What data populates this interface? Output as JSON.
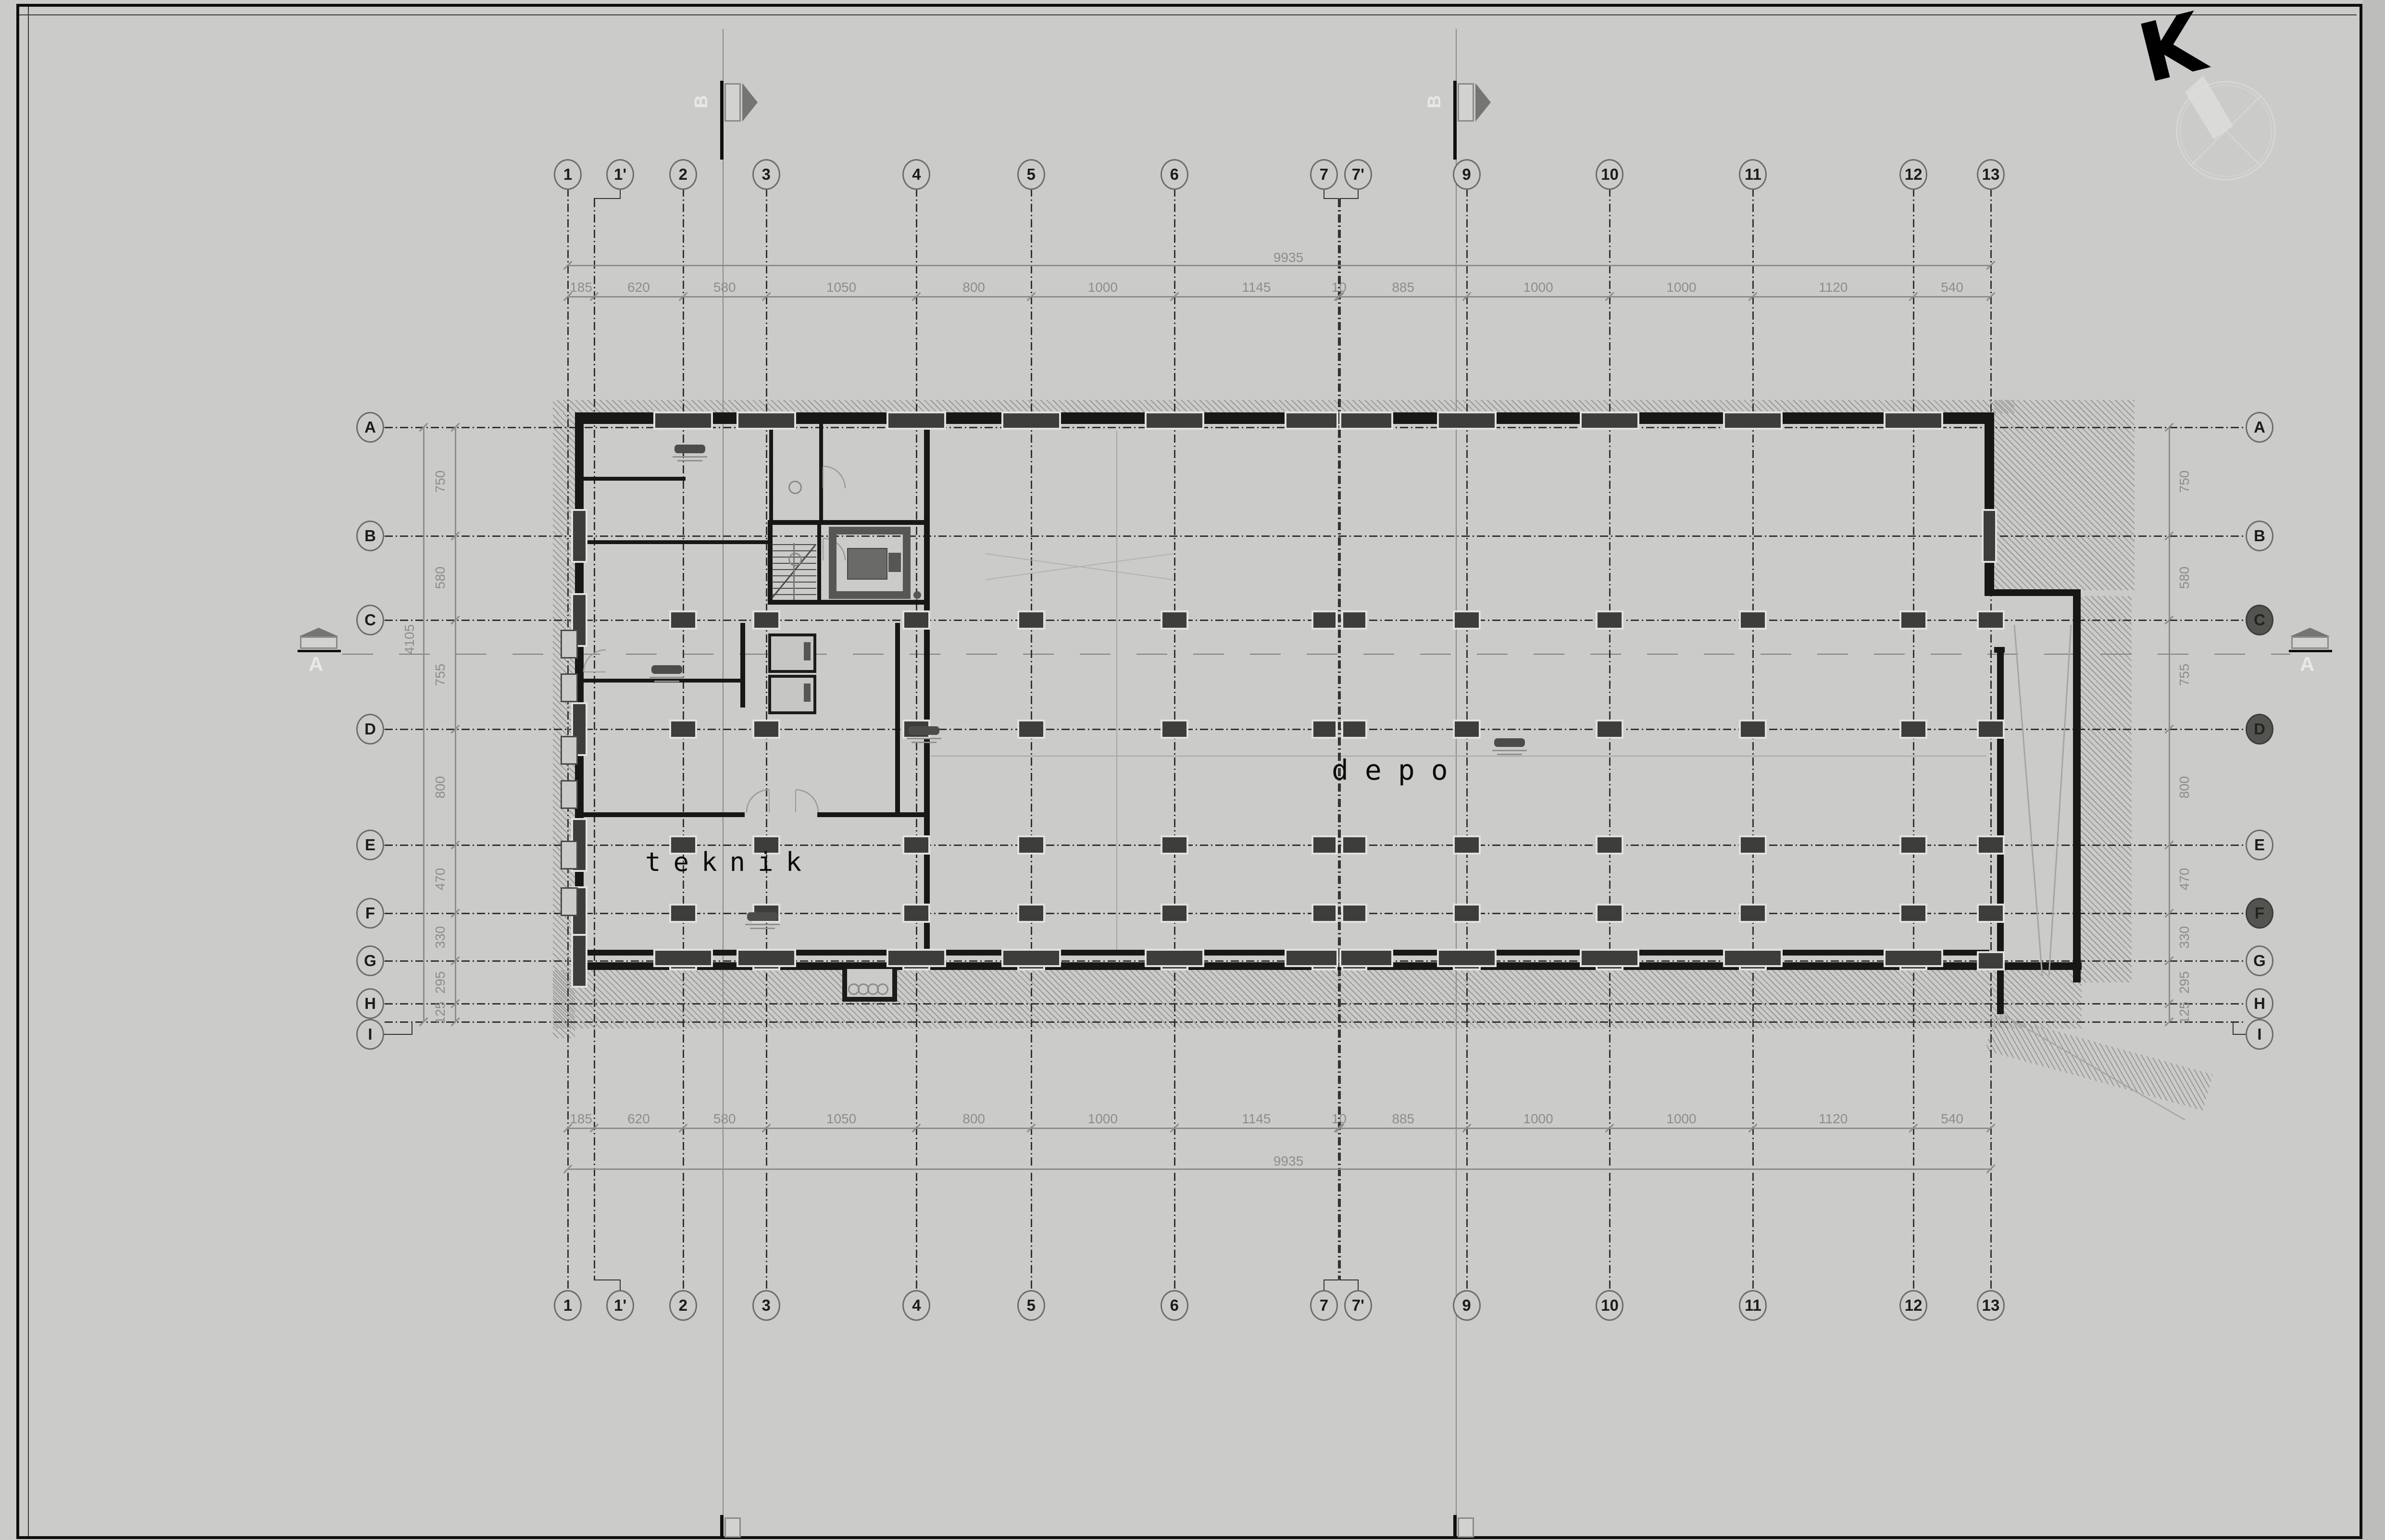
{
  "labels": {
    "depo": "depo",
    "teknik": "teknik"
  },
  "north": {
    "letter": "K"
  },
  "section": {
    "horizontal_letter": "A",
    "vertical_letter": "B"
  },
  "grid": {
    "col_labels": [
      "1",
      "1'",
      "2",
      "3",
      "4",
      "5",
      "6",
      "7",
      "7'",
      "9",
      "10",
      "11",
      "12",
      "13"
    ],
    "col_dims": [
      "185",
      "620",
      "580",
      "1050",
      "800",
      "1000",
      "1145",
      "10",
      "885",
      "1000",
      "1000",
      "1120",
      "540"
    ],
    "row_labels": [
      "A",
      "B",
      "C",
      "D",
      "E",
      "F",
      "G",
      "H",
      "I"
    ],
    "row_dims": [
      "750",
      "580",
      "755",
      "800",
      "470",
      "330",
      "295",
      "125"
    ],
    "total_width": "9935",
    "total_height": "4105",
    "filled_right_bubbles": [
      "C",
      "D",
      "F"
    ]
  },
  "colors": {
    "paper": "#cbcbc9",
    "ink": "#171715",
    "grid_line": "#32322f",
    "dimension": "#8d8d8b",
    "column_fill": "#3d3d3b",
    "light_construction": "#a6a6a4"
  }
}
